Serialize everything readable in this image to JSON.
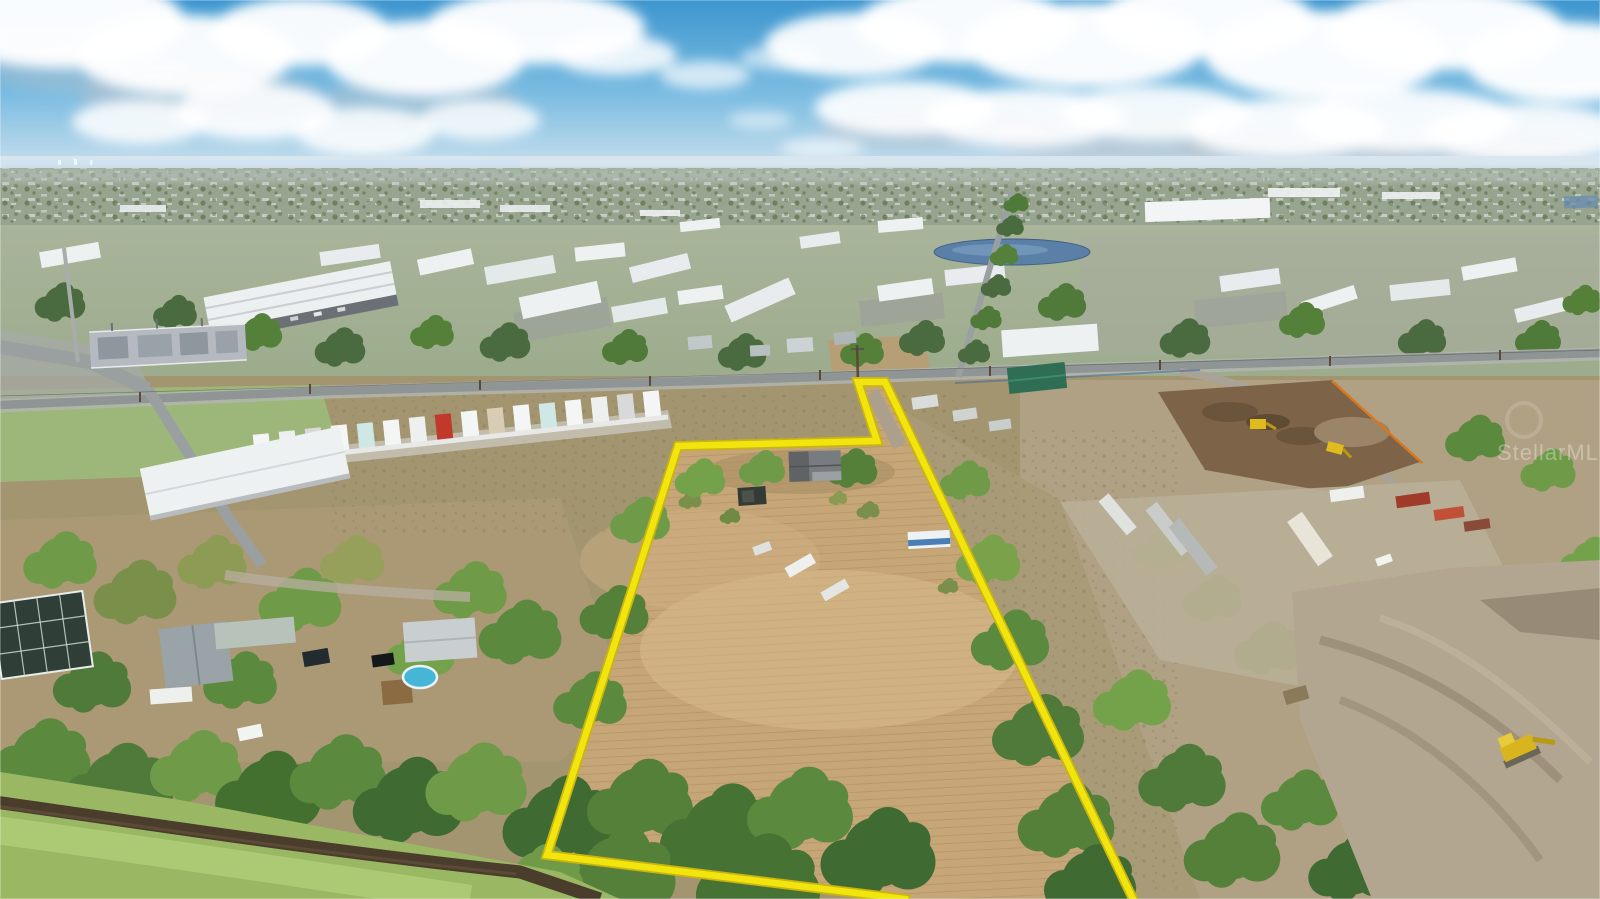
{
  "image": {
    "kind": "aerial-drone-photograph",
    "subject": "vacant land parcel outlined in yellow beside an industrial district, residential lots, a canal and construction yards",
    "width_px": 1600,
    "height_px": 899
  },
  "watermark": {
    "text": "StellarMLS",
    "opacity": "0.32"
  },
  "property_outline": {
    "points": "905,899 547,855 678,446 877,441 858,382 885,382 1133,899",
    "stroke": "#f2e50e",
    "casing": "#c9b410",
    "stroke_width": "6.5",
    "casing_width": "10"
  },
  "palette": {
    "sky_top": "#3d96cf",
    "sky_mid": "#7dbde2",
    "sky_horizon": "#cfe2ee",
    "haze": "#d9e6ef",
    "distant_land": "#97a48f",
    "midland_top": "#a9b49a",
    "midland_bottom": "#9cab8c",
    "south_ground": "#a39570",
    "east_ground": "#b0a184",
    "field_tan": "#c6a677",
    "field_light": "#d8bc8e",
    "scrub_brown": "#a8976f",
    "grass_green": "#9db87a",
    "bank_green": "#9ab864",
    "bank_light": "#aecb74",
    "canal_water": "#4a3d2c",
    "tree_dark": "#3f6b33",
    "tree_mid": "#5b8a3e",
    "tree_light": "#74a24a",
    "tree_olive": "#7a8f4a",
    "road_gray": "#8f9494",
    "roof_white": "#eef1f2",
    "pond_blue": "#5b80a8",
    "mulch_brown": "#7d6449",
    "cleared_dirt": "#b3a690",
    "machine_yellow": "#e0bb1e",
    "pool_blue": "#45b6d6",
    "rv_stripe_blue": "#4a7fb5",
    "cloud_shade": "#b9c2cc",
    "silt_fence_orange": "#d9771e",
    "teal_roof": "#2f6e54"
  }
}
